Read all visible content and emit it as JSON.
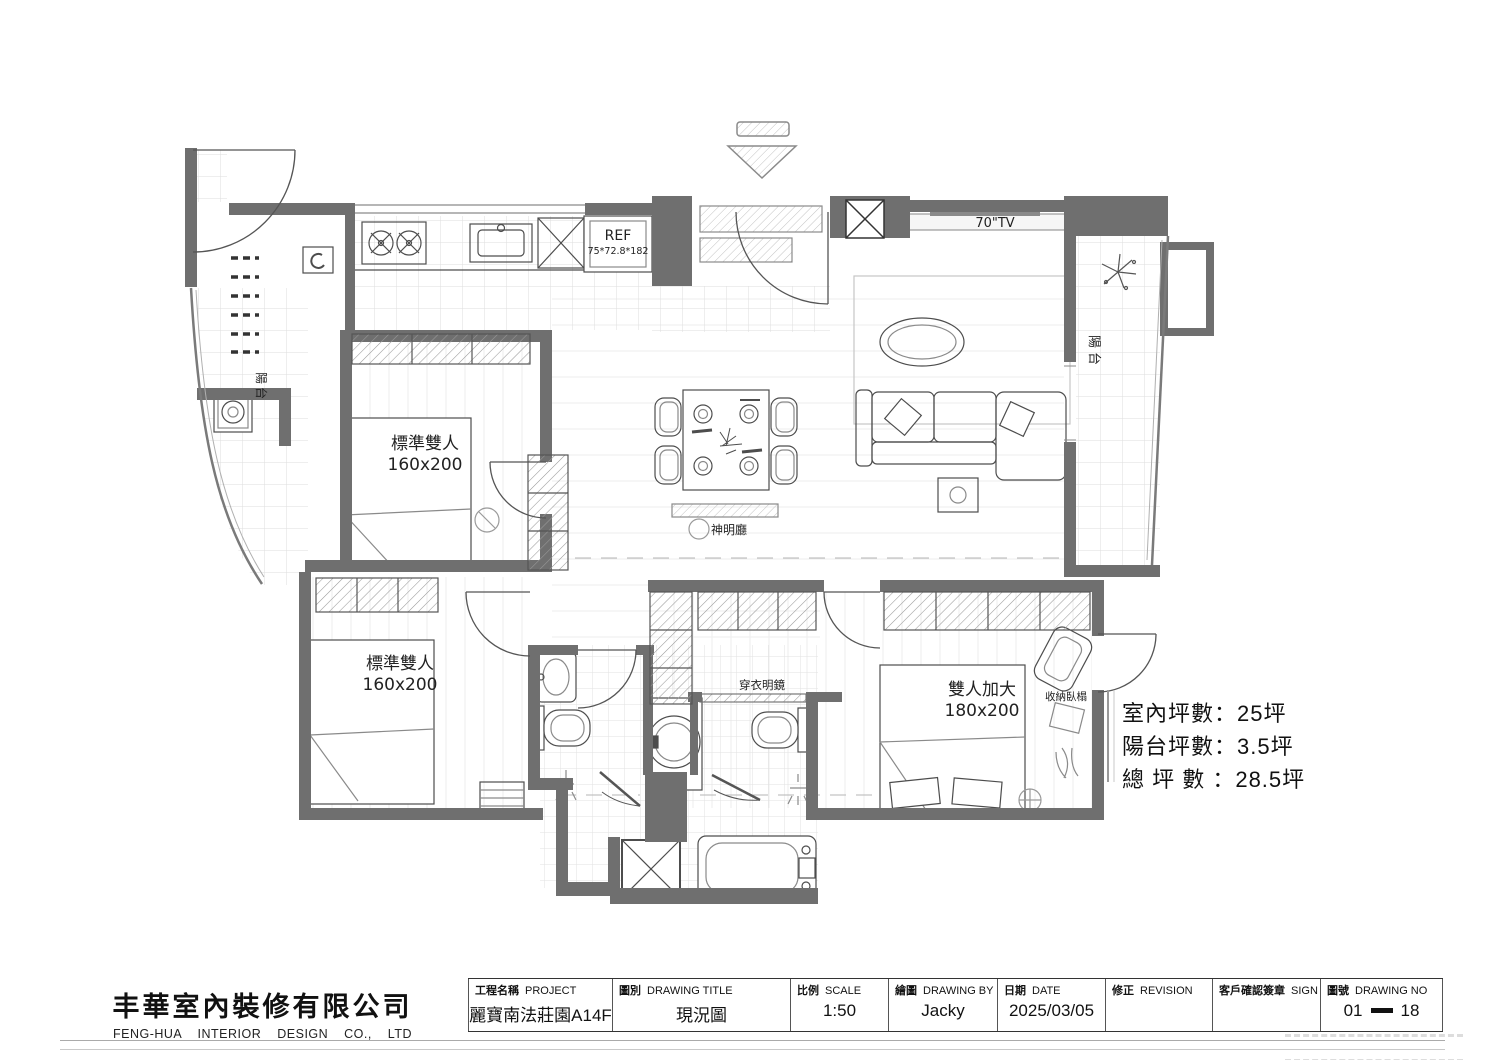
{
  "company": {
    "name_zh": "丰華室內裝修有限公司",
    "name_en": "FENG-HUA INTERIOR DESIGN CO., LTD"
  },
  "title_block": {
    "fields": [
      {
        "label_zh": "工程名稱",
        "label_en": "PROJECT",
        "value": "麗寶南法莊園A14F"
      },
      {
        "label_zh": "圖別",
        "label_en": "DRAWING  TITLE",
        "value": "現況圖"
      },
      {
        "label_zh": "比例",
        "label_en": "SCALE",
        "value": "1:50"
      },
      {
        "label_zh": "繪圖",
        "label_en": "DRAWING  BY",
        "value": "Jacky"
      },
      {
        "label_zh": "日期",
        "label_en": "DATE",
        "value": "2025/03/05"
      },
      {
        "label_zh": "修正",
        "label_en": "REVISION",
        "value": ""
      },
      {
        "label_zh": "客戶確認簽章",
        "label_en": "SIGN",
        "value": ""
      },
      {
        "label_zh": "圖號",
        "label_en": "DRAWING  NO",
        "value_left": "01",
        "value_right": "18"
      }
    ]
  },
  "areas": {
    "indoor": "室內坪數：25坪",
    "balcony": "陽台坪數：3.5坪",
    "total": "總 坪 數 ：28.5坪"
  },
  "plan": {
    "bedroom_top_left": {
      "name": "標準雙人",
      "size": "160x200"
    },
    "bedroom_bottom_left": {
      "name": "標準雙人",
      "size": "160x200"
    },
    "bedroom_right": {
      "name": "雙人加大",
      "size": "180x200"
    },
    "shrine_hall": "神明廳",
    "dressing_mirror": "穿衣明鏡",
    "storage_daybed": "收納臥榻",
    "fridge_label": "REF",
    "fridge_size": "75*72.8*182",
    "tv_label": "70\"TV",
    "balcony_right": "陽台",
    "balcony_left": "陽台"
  },
  "colors": {
    "wall": "#6f6f6f",
    "line": "#4d4d4d",
    "tile": "#dcdcdc",
    "light_text": "#b9b9b9"
  }
}
